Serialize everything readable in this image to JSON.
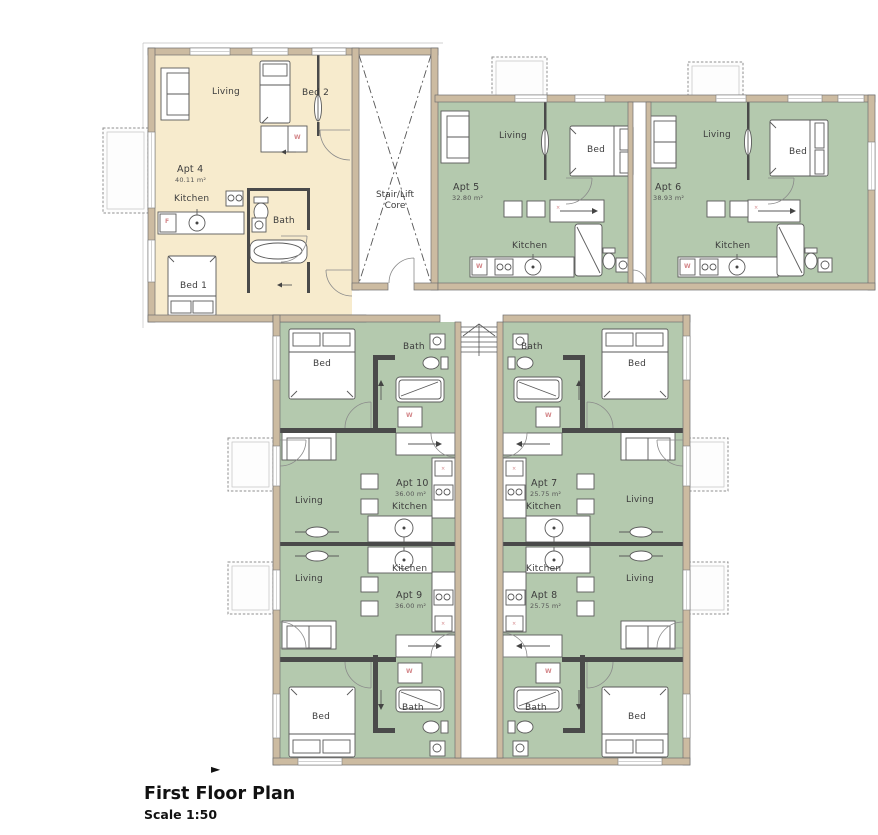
{
  "title_block": {
    "title": "First Floor Plan",
    "scale": "Scale 1:50",
    "marker": "►"
  },
  "core": {
    "line1": "Stair/Lift",
    "line2": "Core"
  },
  "colors": {
    "apt4_fill": "#f7ebcd",
    "apt_green_fill": "#b4c9ae",
    "wall_fill": "#ccbba1",
    "line": "#5a5a5a",
    "appliance_mark": "#d4878a"
  },
  "apartments": {
    "apt4": {
      "name": "Apt 4",
      "area": "40.11 m²",
      "living": "Living",
      "bed2": "Bed 2",
      "kitchen": "Kitchen",
      "bath": "Bath",
      "bed1": "Bed 1"
    },
    "apt5": {
      "name": "Apt 5",
      "area": "32.80 m²",
      "living": "Living",
      "bed": "Bed",
      "kitchen": "Kitchen"
    },
    "apt6": {
      "name": "Apt 6",
      "area": "38.93 m²",
      "living": "Living",
      "bed": "Bed",
      "kitchen": "Kitchen"
    },
    "apt7": {
      "name": "Apt 7",
      "area": "25.75 m²",
      "living": "Living",
      "bed": "Bed",
      "kitchen": "Kitchen",
      "bath": "Bath"
    },
    "apt8": {
      "name": "Apt 8",
      "area": "25.75 m²",
      "living": "Living",
      "bed": "Bed",
      "kitchen": "Kitchen",
      "bath": "Bath"
    },
    "apt9": {
      "name": "Apt 9",
      "area": "36.00 m²",
      "living": "Living",
      "bed": "Bed",
      "kitchen": "Kitchen",
      "bath": "Bath"
    },
    "apt10": {
      "name": "Apt 10",
      "area": "36.00 m²",
      "living": "Living",
      "bed": "Bed",
      "kitchen": "Kitchen",
      "bath": "Bath"
    }
  },
  "marks": {
    "washer": "W",
    "fridge": "F",
    "unit": "×"
  }
}
